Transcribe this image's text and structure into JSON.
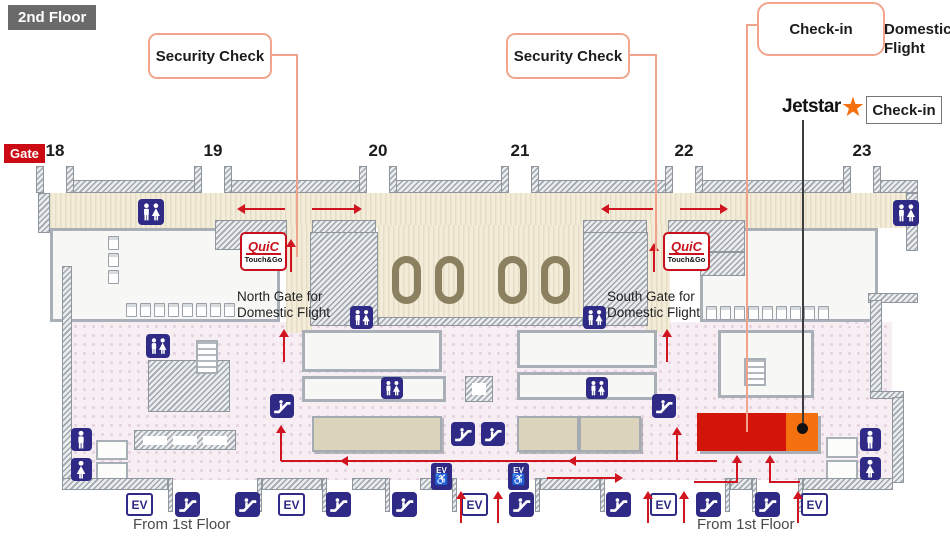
{
  "floor": {
    "label": "2nd Floor"
  },
  "callouts": {
    "security_check_left": "Security Check",
    "security_check_right": "Security Check",
    "checkin": "Check-in",
    "domestic_flight_line1": "Domestic",
    "domestic_flight_line2": "Flight",
    "jetstar": "Jetstar",
    "jetstar_star": "★",
    "jetstar_checkin": "Check-in"
  },
  "gates": {
    "label": "Gate",
    "numbers": [
      "18",
      "19",
      "20",
      "21",
      "22",
      "23"
    ]
  },
  "map_labels": {
    "north_gate_line1": "North Gate for",
    "north_gate_line2": "Domestic Flight",
    "south_gate_line1": "South Gate for",
    "south_gate_line2": "Domestic Flight",
    "from_first_floor_left": "From 1st Floor",
    "from_first_floor_right": "From 1st Floor",
    "quic_name": "QuiC",
    "quic_sub": "Touch&Go",
    "elevator": "EV",
    "accessible_symbol": "♿"
  },
  "icons": {
    "restroom": "restroom-men-women-icon",
    "restroom_men": "restroom-men-icon",
    "restroom_women": "restroom-women-icon",
    "escalator": "escalator-icon",
    "elevator": "elevator-ev-icon",
    "accessible_elevator": "accessible-elevator-icon"
  },
  "colors": {
    "floor_label_bg": "#6a6a6a",
    "gate_badge_red": "#cc0a14",
    "arrow_red": "#d01420",
    "leader_salmon": "#f0a38c",
    "leader_dark": "#3c3c3c",
    "icon_blue": "#2f2a85",
    "counter_red": "#d31408",
    "counter_orange": "#f5700e",
    "wall_gray": "#c3c8cd",
    "corridor_beige": "#f3ecd9",
    "floor_pink": "#f7eef4",
    "oval_olive": "#8b8160",
    "jetstar_orange": "#f5700e"
  }
}
